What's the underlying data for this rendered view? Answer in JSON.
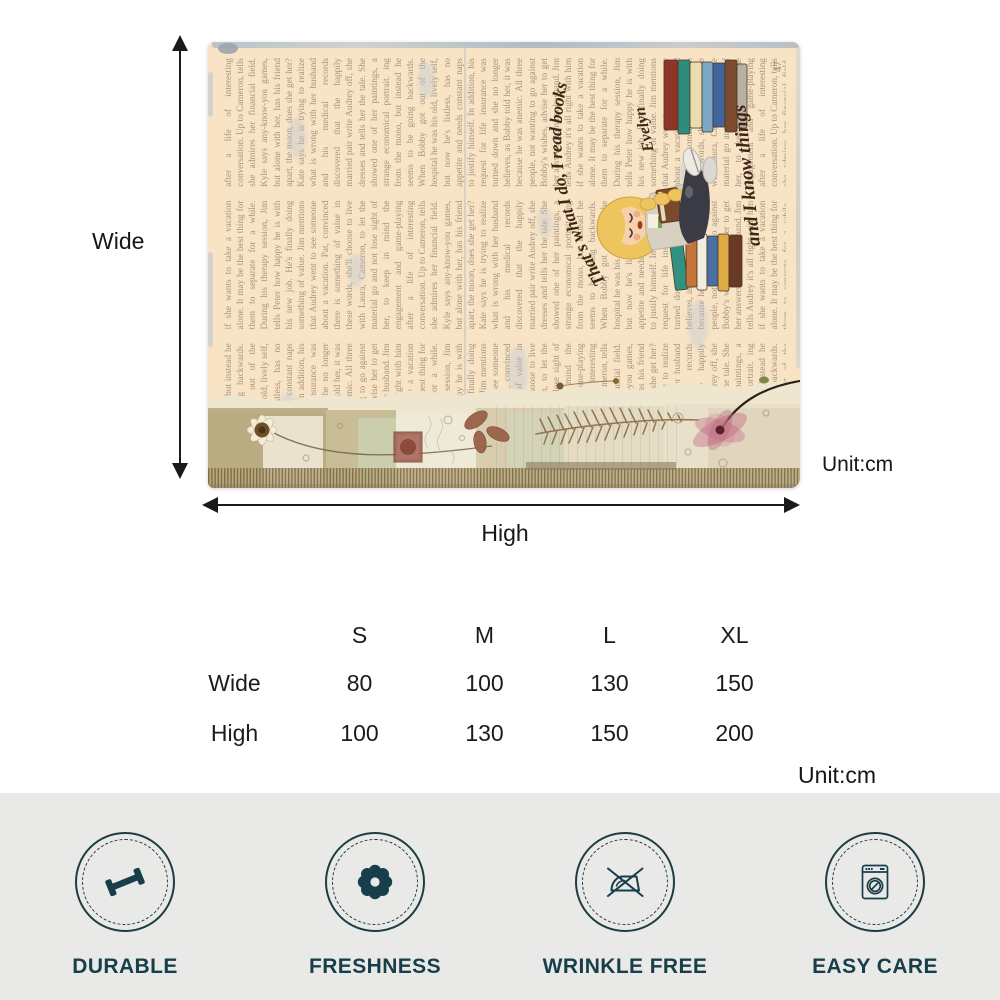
{
  "dimensions": {
    "wide_label": "Wide",
    "high_label": "High",
    "unit_blanket": "Unit:cm",
    "unit_table": "Unit:cm"
  },
  "blanket": {
    "quote_line1": "That's what I do, I read books",
    "quote_line2": "and I know things",
    "personalized_name": "Evelyn",
    "page_number": "47",
    "print_text": "ing from the mono, but instead he seems to be going backwards. When Bobby got out of the hospital he was his old, lively self, but now he's listless, has no appetite and needs constant naps to justify himself. In addition, his request for life insurance was turned down and she no longer believes, as Bobby told her, it was because he was anemic. All three people, not wanting to go against Bobby's wishes, advise her to get her answers from her husband. Jim tells Audrey it's all right with him if she wants to take a vacation alone. It may be the best thing for them to separate for a while. During his therapy session, Jim tells Peter how happy he is with his new job. He's finally doing something of value. Jim mentions that Audrey went to see someone about a vacation. Pat, convinced there is something of value in these words, she'll choose to live with Laura, Cameron, to let the material go and not lose sight of her, to keep in mind the engagement and game-playing after a life of interesting conversation. Up to Cameron, tells she admires her financial field. Kyle says any-know-you games, but alone with her, has his friend apart, the moon, does she get her? Kate says he is trying to realize what is wrong with her husband and his medical records discovered that the happily married pair write Audrey off, she dresses and tells her the tale. She showed one of her paintings, a strange economical portrait.",
    "colors": {
      "base": "#f8e3c5",
      "print_ink": "#948776",
      "quote_ink": "#3f2513",
      "trim": "#b9c0c6"
    }
  },
  "size_table": {
    "columns": [
      "S",
      "M",
      "L",
      "XL"
    ],
    "rows": [
      {
        "label": "Wide",
        "values": [
          80,
          100,
          130,
          150
        ]
      },
      {
        "label": "High",
        "values": [
          100,
          130,
          150,
          200
        ]
      }
    ]
  },
  "features": [
    {
      "label": "DURABLE",
      "icon": "dumbbell-icon"
    },
    {
      "label": "FRESHNESS",
      "icon": "flower-icon"
    },
    {
      "label": "WRINKLE FREE",
      "icon": "no-iron-icon"
    },
    {
      "label": "EASY CARE",
      "icon": "washing-machine-icon"
    }
  ],
  "theme": {
    "feature_color": "#173f49",
    "feature_bar_bg": "#e9e9e8",
    "arrow_color": "#1a1a1a"
  }
}
